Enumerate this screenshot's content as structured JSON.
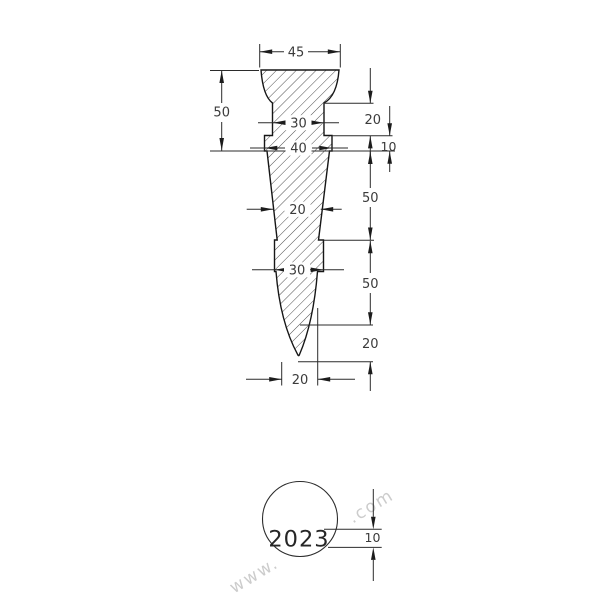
{
  "dims": {
    "top_width": "45",
    "upper_height": "50",
    "neck_width": "30",
    "neck_height": "20",
    "collar1_width": "40",
    "collar1_height": "10",
    "cone_upper_height": "50",
    "cone_mid_width": "20",
    "collar2_width": "30",
    "cone_lower_height": "50",
    "tip_height": "20",
    "tip_width": "20"
  },
  "detail": {
    "year": "2023",
    "text_height": "10"
  },
  "watermark": {
    "prefix": "www.",
    "suffix": ".com"
  },
  "colors": {
    "line": "#2b2b2b",
    "outline": "#161616",
    "text": "#3b3b3b",
    "watermark": "#cccccc",
    "background": "#ffffff"
  }
}
